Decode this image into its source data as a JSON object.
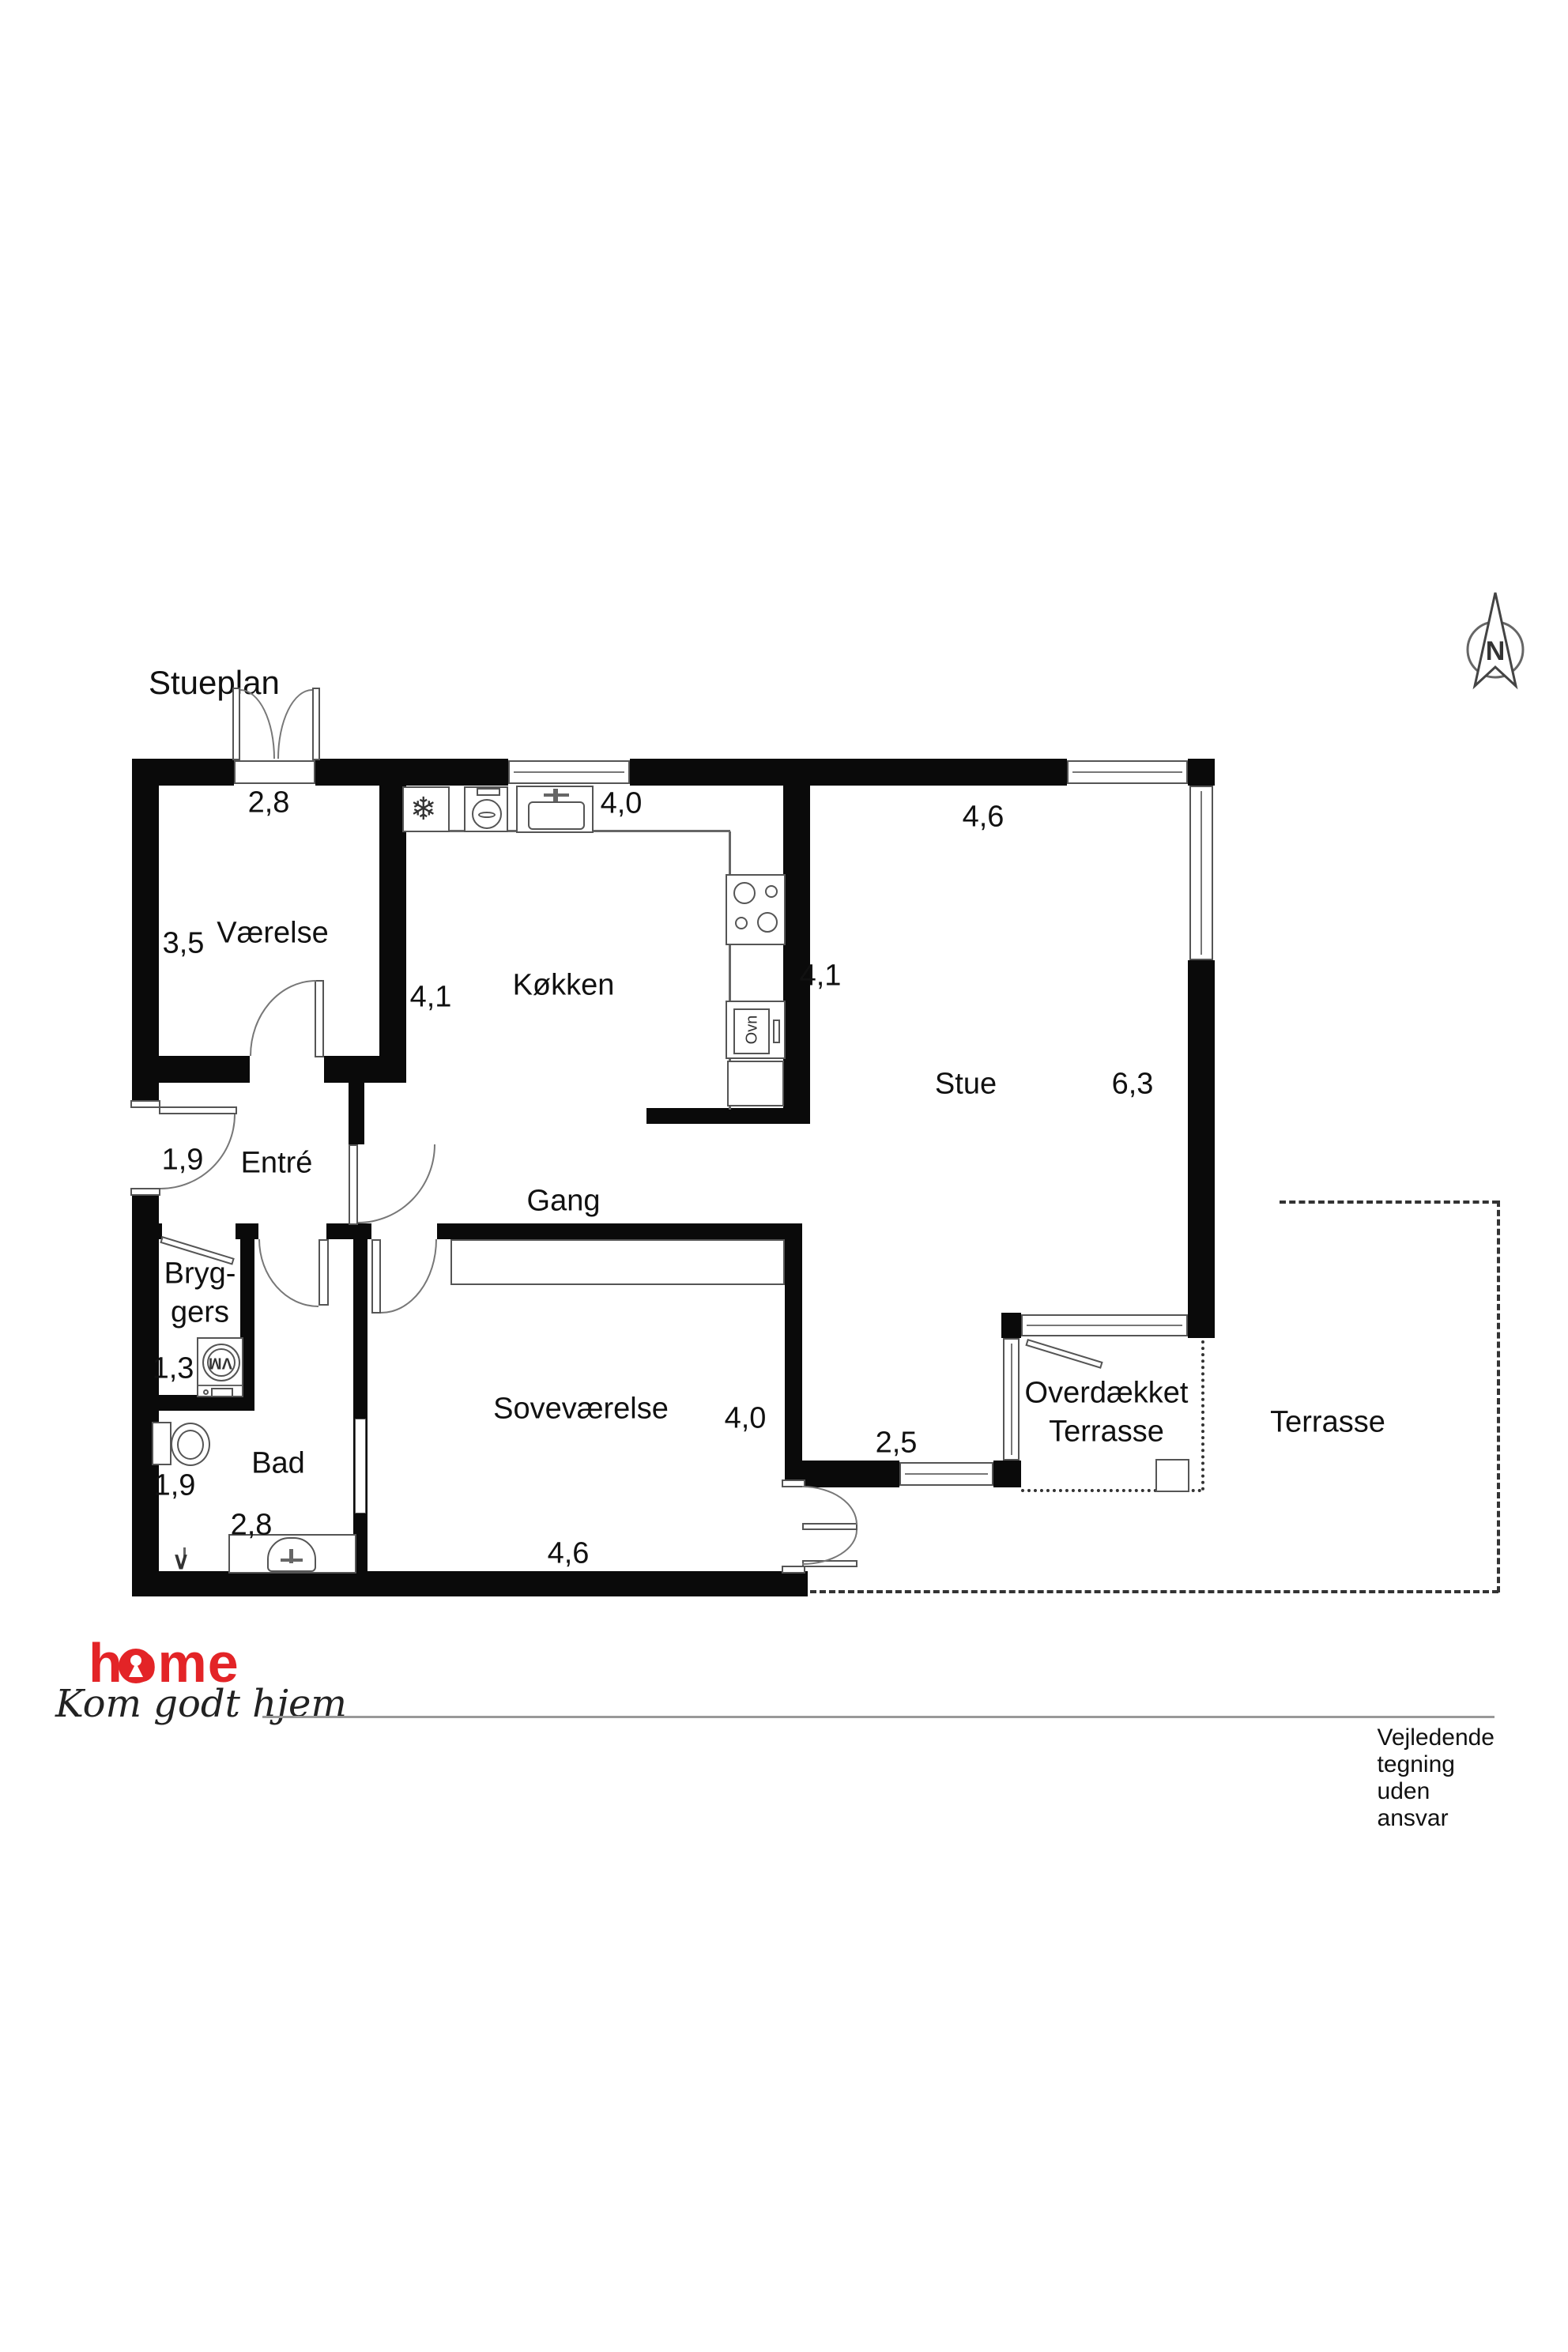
{
  "title": "Stueplan",
  "compass": {
    "north": "N"
  },
  "labels": {
    "vaerelse": "Værelse",
    "kokken": "Køkken",
    "stue": "Stue",
    "entre": "Entré",
    "gang": "Gang",
    "bryggers_line1": "Bryg-",
    "bryggers_line2": "gers",
    "bad": "Bad",
    "sovevaerelse": "Soveværelse",
    "overdaekket_line1": "Overdækket",
    "overdaekket_line2": "Terrasse",
    "terrasse": "Terrasse"
  },
  "dimensions": {
    "vaerelse_width": "2,8",
    "vaerelse_depth": "3,5",
    "kokken_width": "4,0",
    "kokken_depth_left": "4,1",
    "kokken_depth_right": "4,1",
    "stue_width": "4,6",
    "stue_depth": "6,3",
    "entre_width": "1,9",
    "bryggers_width": "1,3",
    "bad_width": "1,9",
    "bad_depth": "2,8",
    "sovevaerelse_width": "4,6",
    "sovevaerelse_depth": "4,0",
    "passage_width": "2,5"
  },
  "appliances": {
    "oven": "Ovn",
    "washing_machine": "VM"
  },
  "icons": {
    "fridge_snowflake": "❄",
    "drain": "∨"
  },
  "footer": {
    "brand": "home",
    "tagline": "Kom godt hjem",
    "disclaimer": "Vejledende tegning uden ansvar"
  },
  "colors": {
    "brand_red": "#e32427",
    "wall_black": "#0a0a0a"
  }
}
